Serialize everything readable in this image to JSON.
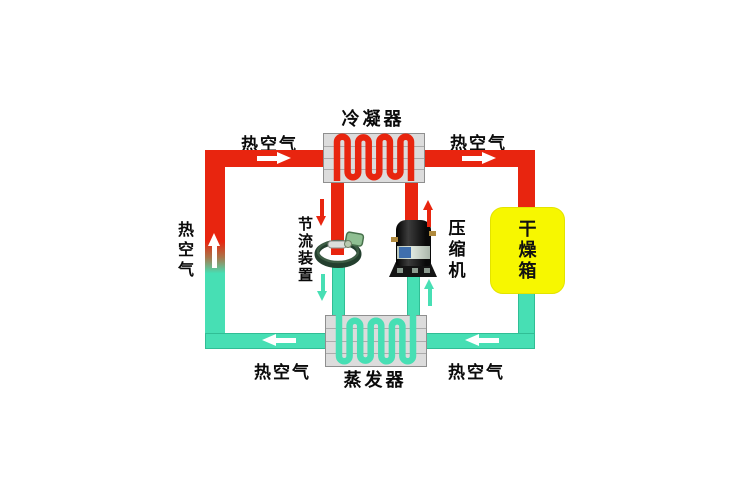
{
  "labels": {
    "condenser": "冷凝器",
    "evaporator": "蒸发器",
    "throttle_device": "节流装置",
    "compressor": "压缩机",
    "drying_box": "干燥箱"
  },
  "air_labels": {
    "top_left": "热空气",
    "top_right": "热空气",
    "bottom_left": "热空气",
    "bottom_right": "热空气",
    "left_side": "热空气"
  },
  "colors": {
    "hot_pipe": "#e8250f",
    "cold_pipe": "#47dfb4",
    "drying_box_fill": "#f7f700",
    "heat_exchanger_fill": "#dcdcdc",
    "air_arrow": "#ffffff"
  }
}
